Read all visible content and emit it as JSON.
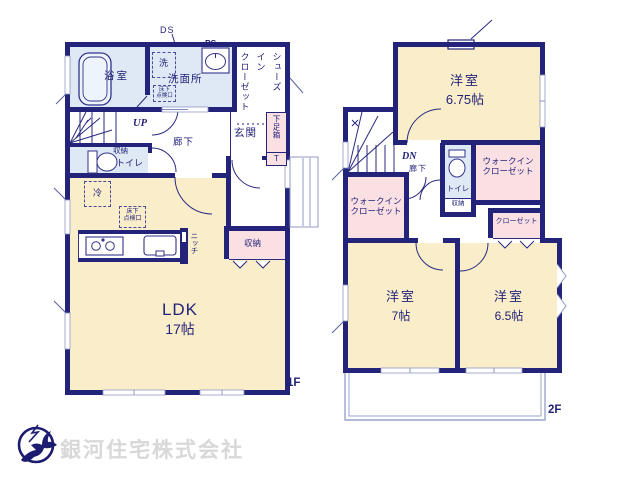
{
  "colors": {
    "wall": "#232379",
    "room_cream": "#f9edca",
    "room_pink": "#fadfe3",
    "room_blue": "#dfe9f5",
    "balcony_line": "#9aa4cc",
    "logo_mark": "#1c1c70",
    "logo_text": "#d8d8d8"
  },
  "floor1": {
    "label": "1F",
    "ds": "DS",
    "ps": "PS",
    "bathroom": "浴室",
    "washer": "洗",
    "washroom": "洗面所",
    "hatch_line1": "床下",
    "hatch_line2": "点検口",
    "shoes_closet_cols": [
      "シューズ",
      "イン",
      "クローゼット"
    ],
    "up": "UP",
    "corridor": "廊下",
    "entrance": "玄関",
    "shoe_box": "下足箱",
    "shoe_box_t": "T",
    "storage": "収納",
    "toilet": "トイレ",
    "fridge": "冷",
    "niche": "ニッチ",
    "ldk_name": "LDK",
    "ldk_size": "17帖"
  },
  "floor2": {
    "label": "2F",
    "dn": "DN",
    "corridor": "廊下",
    "toilet": "トイレ",
    "storage": "収納",
    "room_a": "洋室",
    "room_a_size": "6.75帖",
    "room_b": "洋室",
    "room_b_size": "7帖",
    "room_c": "洋室",
    "room_c_size": "6.5帖",
    "wic_line1": "ウォークイン",
    "wic_line2": "クローゼット",
    "closet": "クローゼット"
  },
  "company": {
    "name": "銀河住宅株式会社"
  }
}
